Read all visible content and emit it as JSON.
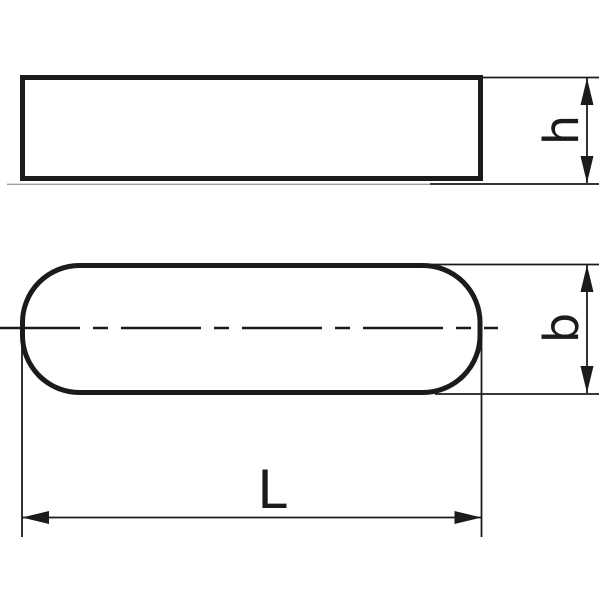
{
  "drawing": {
    "background_color": "#ffffff",
    "line_color": "#1b1b1b",
    "dimension_labels": {
      "height": "h",
      "width": "b",
      "length": "L"
    }
  }
}
